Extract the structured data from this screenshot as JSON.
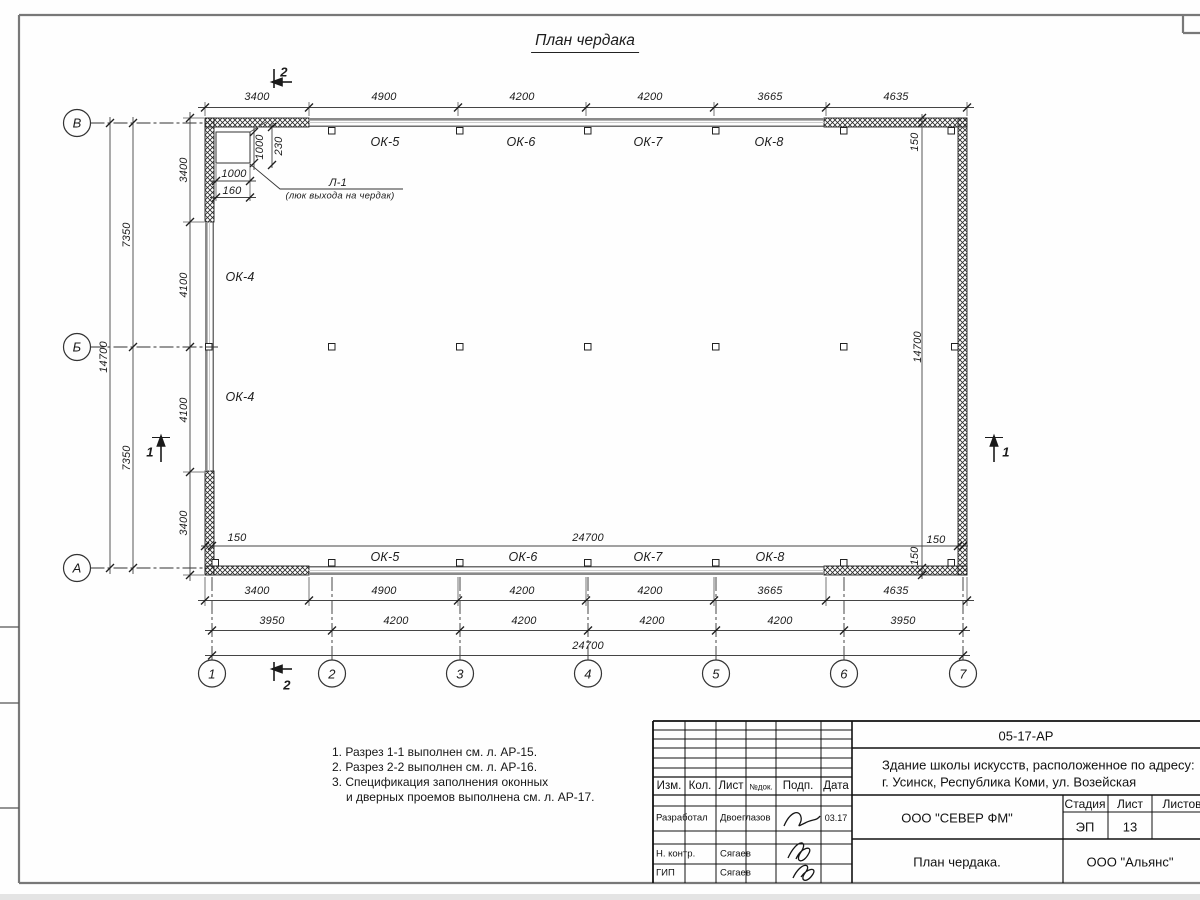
{
  "palette": {
    "ink": "#1c1c1c",
    "wall_gray": "#8a8a8a",
    "frame_gray": "#787878"
  },
  "title": "План чердака",
  "axes": {
    "rows": [
      "В",
      "Б",
      "А"
    ],
    "cols": [
      "1",
      "2",
      "3",
      "4",
      "5",
      "6",
      "7"
    ]
  },
  "section_marks": {
    "one": "1",
    "two": "2"
  },
  "windows": {
    "top": [
      "ОК-5",
      "ОК-6",
      "ОК-7",
      "ОК-8"
    ],
    "bottom": [
      "ОК-5",
      "ОК-6",
      "ОК-7",
      "ОК-8"
    ],
    "left": [
      "ОК-4",
      "ОК-4"
    ]
  },
  "hatch_door": {
    "label": "Л-1",
    "note": "(люк выхода на чердак)",
    "dim_width": "1000",
    "dim_height": "1000",
    "dim_offset": "160",
    "dim_inset": "230"
  },
  "dims": {
    "top": [
      "3400",
      "4900",
      "4200",
      "4200",
      "3665",
      "4635"
    ],
    "bottom_r1": [
      "3400",
      "4900",
      "4200",
      "4200",
      "3665",
      "4635"
    ],
    "bottom_r2": [
      "3950",
      "4200",
      "4200",
      "4200",
      "4200",
      "3950"
    ],
    "bottom_total": "24700",
    "left_r1": [
      "3400",
      "4100",
      "4100",
      "3400"
    ],
    "left_r2": [
      "7350",
      "7350"
    ],
    "left_total": "14700",
    "inner_width": "24700",
    "inner_height": "14700",
    "ledge": "150"
  },
  "notes": [
    "1. Разрез 1-1 выполнен см. л. АР-15.",
    "2. Разрез 2-2 выполнен см. л. АР-16.",
    "3. Спецификация заполнения оконных",
    "и дверных проемов выполнена см. л. АР-17."
  ],
  "titleblock": {
    "doc_code": "05-17-АР",
    "address_line1": "Здание школы искусств, расположенное по адресу:",
    "address_line2": "г. Усинск, Республика Коми, ул. Возейская",
    "header": {
      "izm": "Изм.",
      "kol": "Кол.",
      "list": "Лист",
      "ndok": "№док.",
      "podp": "Подп.",
      "data": "Дата"
    },
    "rows": [
      {
        "role": "Разработал",
        "name": "Двоеглазов",
        "date": "03.17"
      },
      {
        "role": "Н. контр.",
        "name": "Сягаев",
        "date": ""
      },
      {
        "role": "ГИП",
        "name": "Сягаев",
        "date": ""
      }
    ],
    "company": "ООО \"СЕВЕР ФМ\"",
    "stage_label": "Стадия",
    "sheet_label": "Лист",
    "sheets_label": "Листов",
    "stage": "ЭП",
    "sheet": "13",
    "drawing_name": "План чердака.",
    "org": "ООО \"Альянс\""
  }
}
